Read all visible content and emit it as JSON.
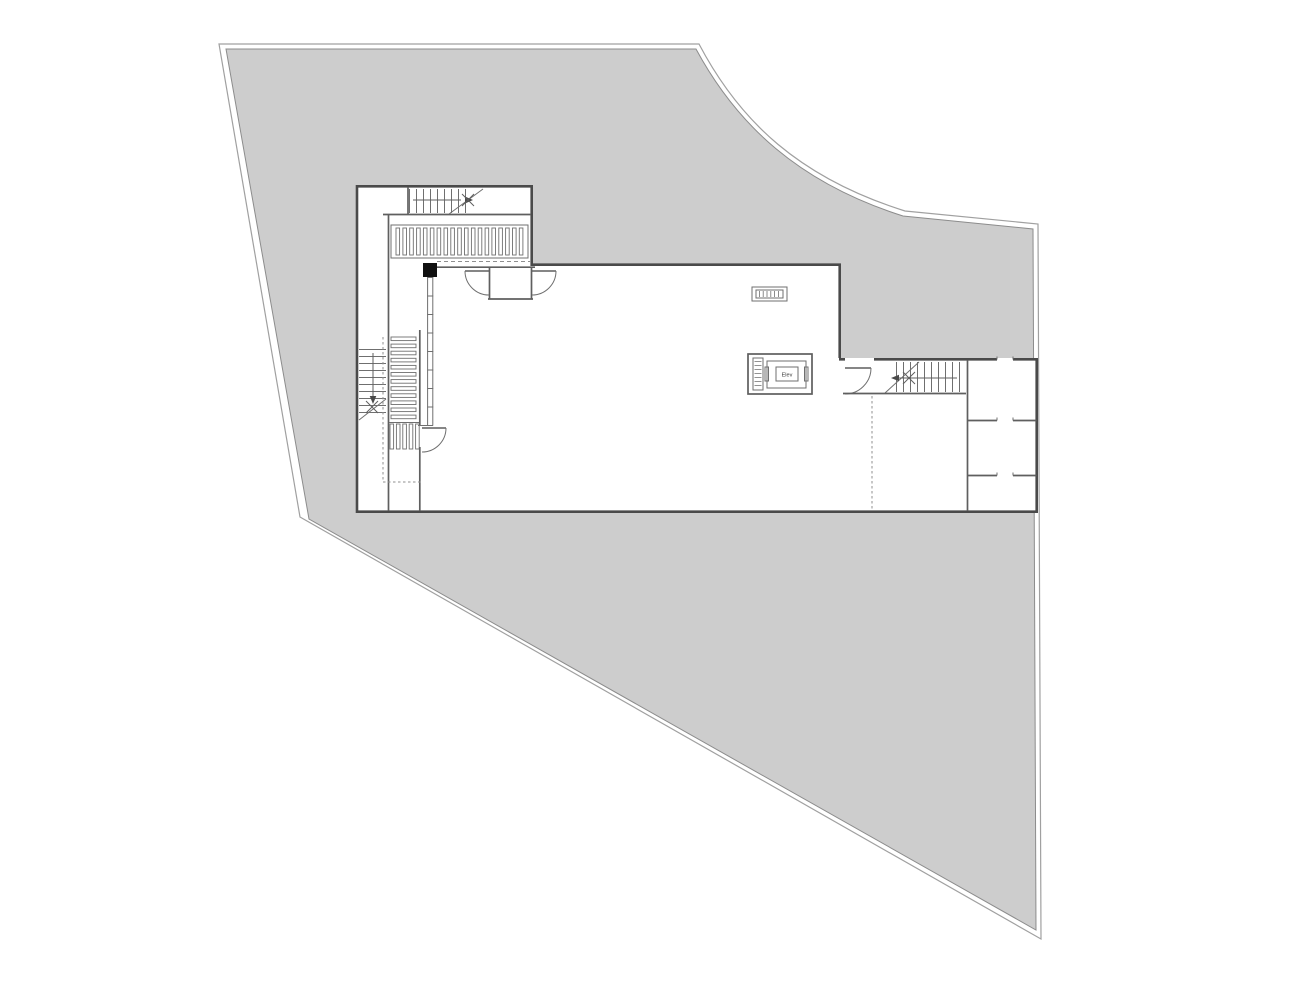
{
  "labels": {
    "elevator": "Elev"
  },
  "colors": {
    "paper": "#ffffff",
    "site_fill": "#cdcdcd",
    "site_outline": "#a0a0a0",
    "site_inner_line": "#8c8c8c",
    "wall": "#4a4a4a",
    "wall_medium": "#5f5f5f",
    "detail": "#6f6f6f",
    "dash": "#8f8f8f",
    "column": "#101010",
    "label": "#333333"
  }
}
